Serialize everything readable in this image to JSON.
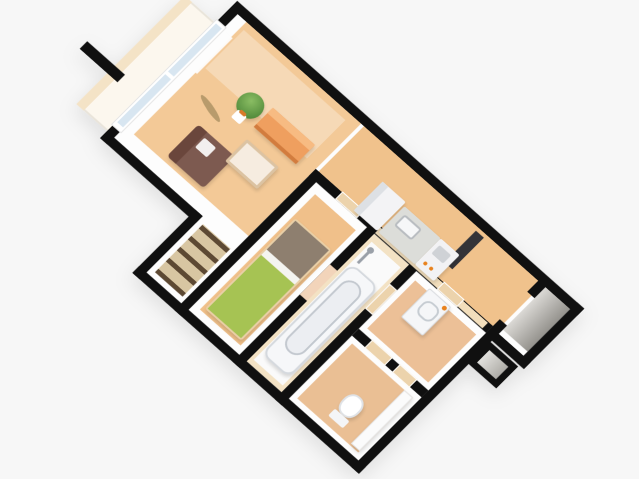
{
  "scene": {
    "title": "3D isometric apartment floor plan render",
    "background": "#f7f7f7",
    "wall_color": "#101010",
    "wall_face": "#fdfdfd"
  },
  "rooms": {
    "balcony": {
      "label": "balcony",
      "floor": "#fcf7ee",
      "edge_band": "#f4e3c6",
      "outline": "#e9e4da"
    },
    "living_room": {
      "label": "living-dining room",
      "floor": "#f3c997",
      "light_patch": "rgba(255,255,255,0.30)"
    },
    "hallway_kitchen": {
      "label": "hallway and kitchen",
      "floor": "#f0c28c",
      "wall_face_band": "#f2debc"
    },
    "bedroom": {
      "label": "bedroom",
      "floor": "#f0c08a"
    },
    "closet": {
      "label": "closet",
      "doors": "repeating-linear-gradient(0deg,#5d4933 0 5px,#d8c6a2 5px 16px)"
    },
    "bathroom": {
      "label": "unit bathroom",
      "wall": "#f3e2c4",
      "floor": "#fafafa"
    },
    "washroom": {
      "label": "washroom",
      "floor": "#ecc097"
    },
    "toilet_room": {
      "label": "toilet room",
      "floor": "#eabf94"
    },
    "entrance": {
      "label": "entrance (genkan)",
      "floor_gradient": "linear-gradient(90deg,#dbd9d5,#94928d)",
      "open_door": "#333338"
    },
    "nook": {
      "label": "shoe closet nook",
      "floor_gradient": "linear-gradient(90deg,#e2e1dd,#aeaca7)"
    }
  },
  "furniture": {
    "window": {
      "frame": "#ffffff",
      "glass": "#d8e6f1",
      "curtain": "#fdfdfd"
    },
    "potted_plant": {
      "foliage": "radial-gradient(circle at 40% 35%,#8abd63,#3f7a2e)",
      "pot": "#ffffff",
      "soil": "#d97a2a"
    },
    "sofa": {
      "body": "#7d5a50",
      "back": "#6a463c",
      "cushion": "#ffffff"
    },
    "coffee_table": {
      "top": "#f6ece0",
      "edge": "#dcc3a2"
    },
    "sideboard": {
      "body": "#ef9f5f",
      "top": "#f7bb82",
      "side": "#d27c3e"
    },
    "floor_grass": {
      "color": "#867549"
    },
    "bed": {
      "frame": "#e9cfa6",
      "head": "#8e7f6f",
      "sheet": "#f4f4f0",
      "duvet": "#a6c353"
    },
    "fridge": {
      "body": "#f3f3f5",
      "side": "#dde0e4"
    },
    "kitchen_counter": {
      "body": "#dcddd9",
      "sink": "#f6f7f8",
      "sink_edge": "#b8bcc0"
    },
    "stove": {
      "body": "#f2f2f4",
      "grill": "#cfd2d6",
      "knob": "#e8821e"
    },
    "bathtub": {
      "body": "#f6f7f9",
      "rim": "#d5d9de",
      "inner": "#eceef2",
      "inner_edge": "#c3c8cf"
    },
    "shower": {
      "color": "#9aa0a8"
    },
    "washbasin": {
      "body": "#f5f6f8",
      "edge": "#d9dce0",
      "basin_edge": "#c6ccd2",
      "accent": "#e8821e"
    },
    "toilet": {
      "body": "#ffffff",
      "edge": "#dfe2e6",
      "tank": "#f4f5f7"
    },
    "toilet_counter": {
      "body": "#fbfbfb",
      "edge": "#e5e5e5"
    },
    "interior_door": {
      "color": "#ecd3ac",
      "frame": "#ffffff"
    },
    "pink_door": {
      "color": "#f2d4ba"
    }
  }
}
